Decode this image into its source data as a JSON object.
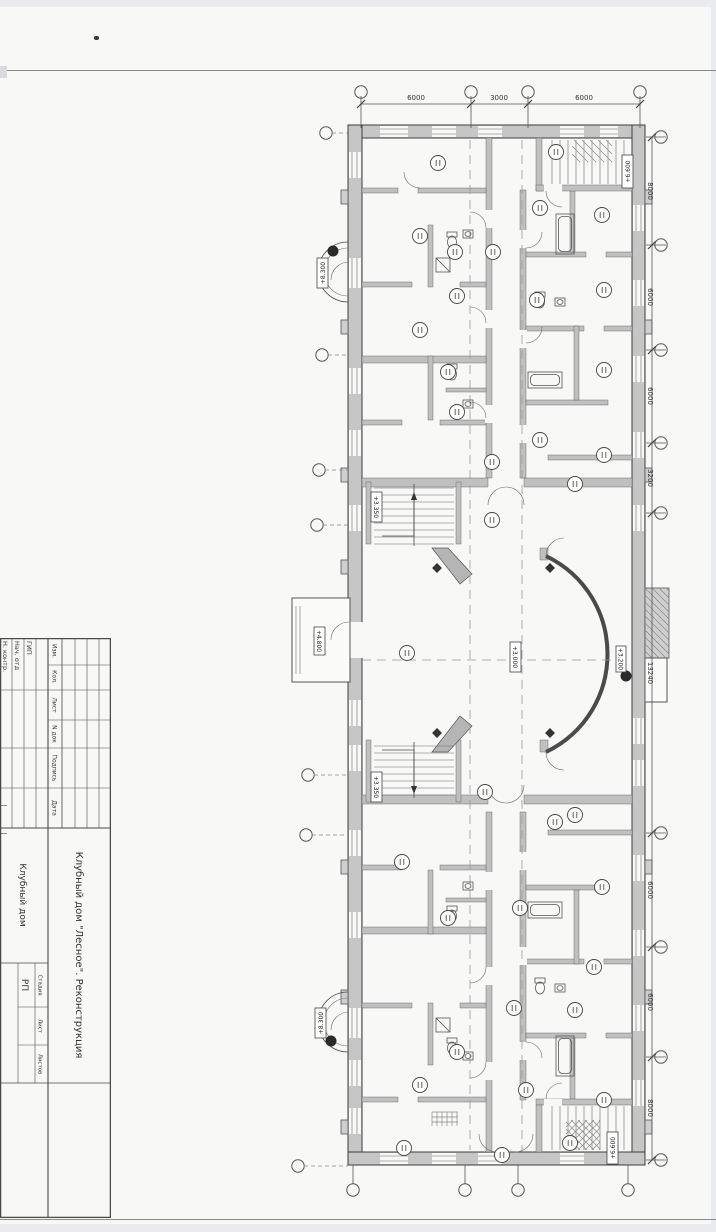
{
  "stamp": {
    "header_cols": [
      "Изм.",
      "Кол.",
      "Лист",
      "N док",
      "Подпись",
      "Дата"
    ],
    "roles": [
      "ГИП",
      "Нач. отд",
      "Н. контр."
    ],
    "project": "Клубный дом \"Лесное\". Реконструкция",
    "object": "Клубный дом",
    "stage_label": "Стадия",
    "sheet_label": "Лист",
    "sheets_label": "Листов",
    "stage_value": "РП"
  },
  "plan": {
    "top_dims": [
      "6000",
      "3000",
      "6000"
    ],
    "right_dims": [
      "8000",
      "6000",
      "6000",
      "3200",
      "13240",
      "6000",
      "6000",
      "8000"
    ],
    "elevations": {
      "stair_top": "+6.600",
      "balcony_top": "+8.300",
      "hall_stair_upper": "+3.350",
      "hall": "+3.000",
      "porch": "+4.800",
      "annex": "+3.200",
      "hall_stair_lower": "+3.350",
      "balcony_bottom": "+8.300",
      "stair_bottom": "+6.600"
    }
  }
}
